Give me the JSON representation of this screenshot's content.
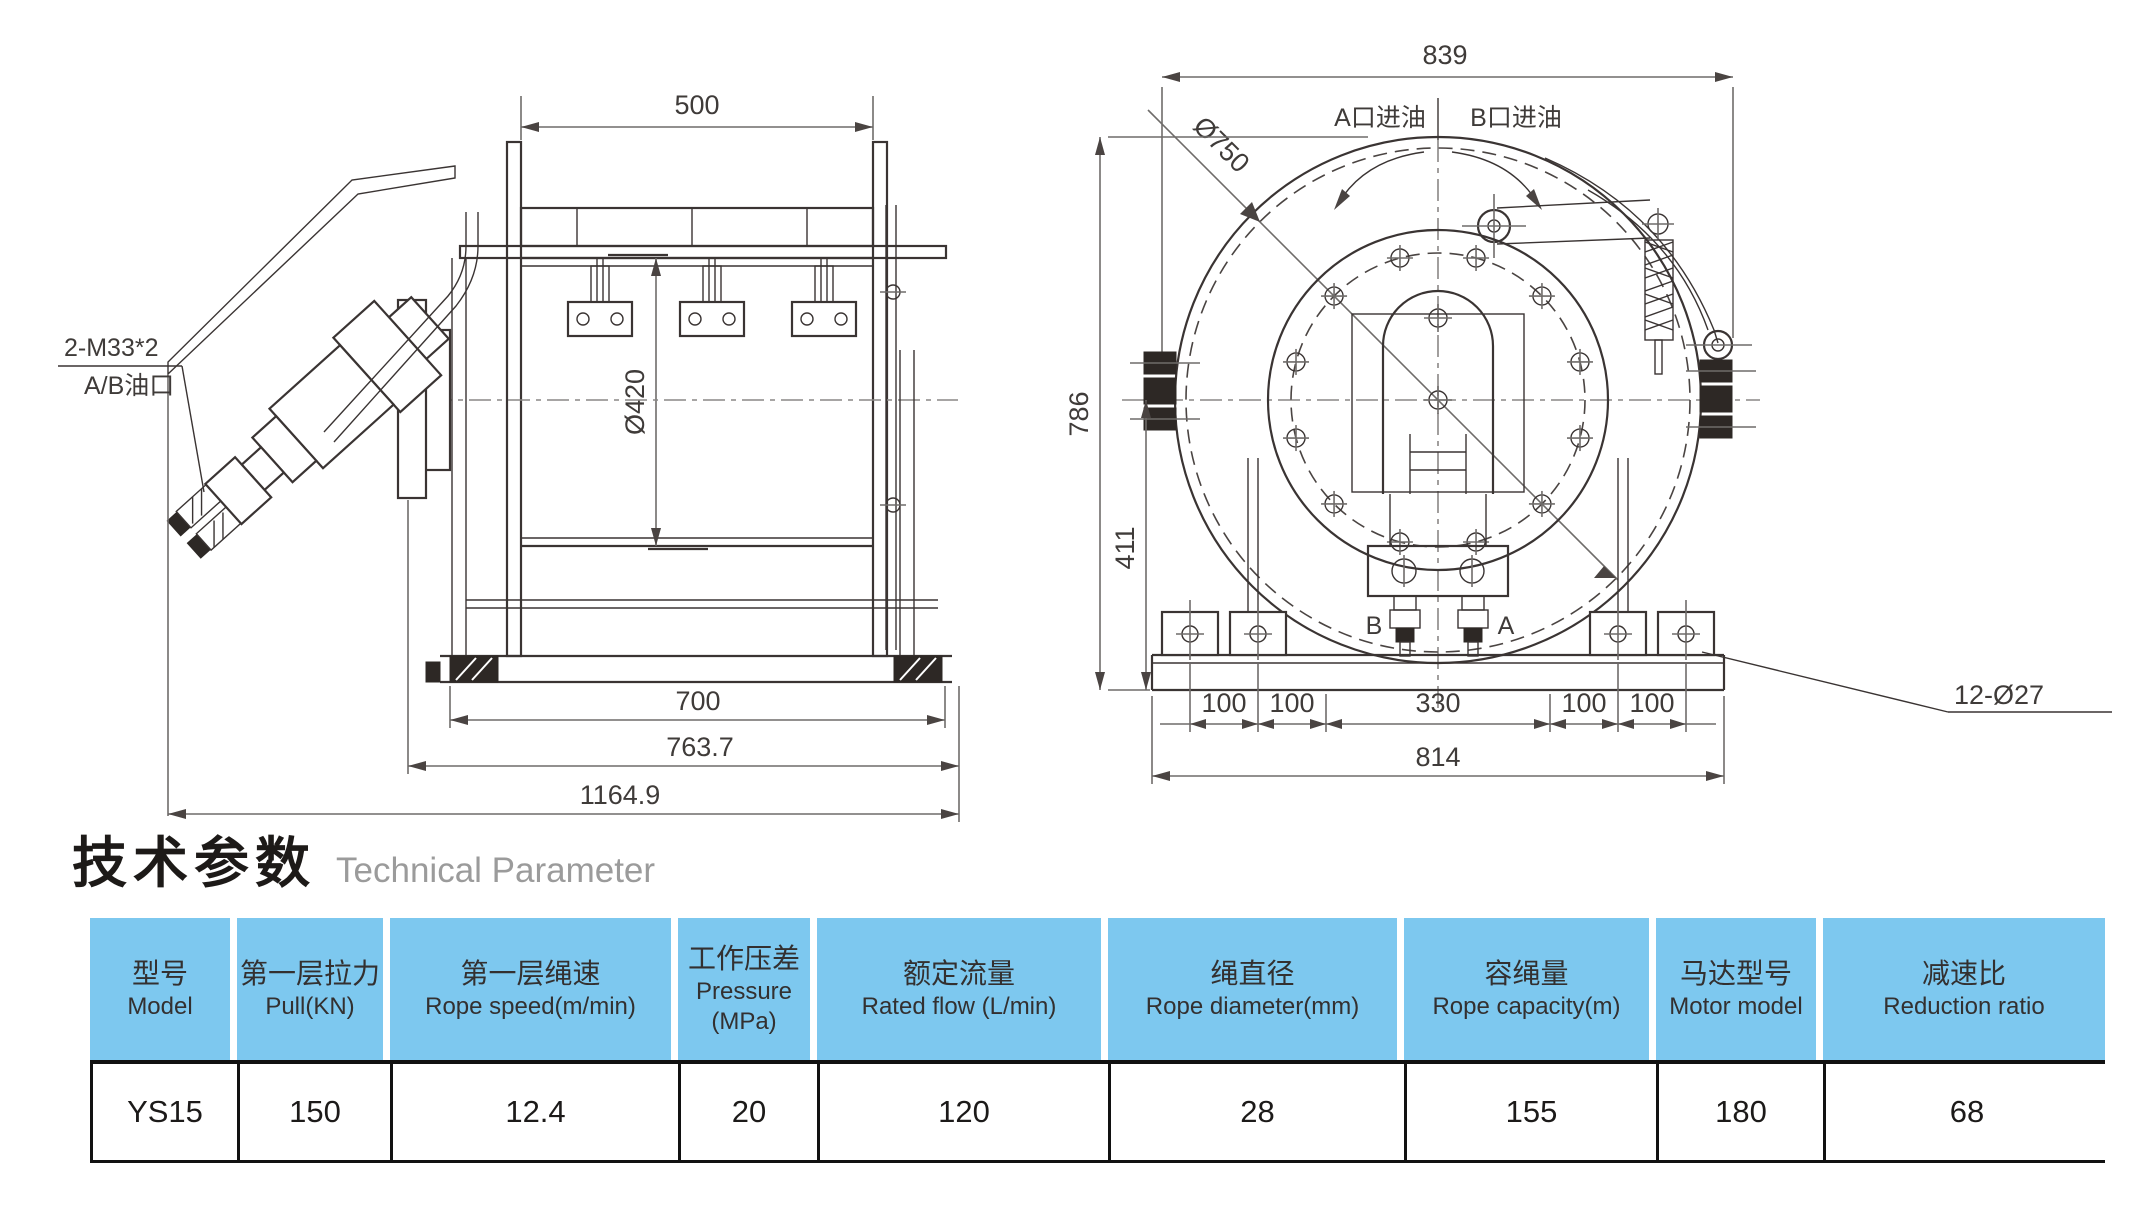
{
  "title": {
    "zh": "技术参数",
    "en": "Technical Parameter"
  },
  "colors": {
    "header_bg": "#7dc8ef",
    "line": "#3a3433",
    "dim_line": "#6f6c6a",
    "title_gray": "#9b9b9b",
    "table_border": "#111111"
  },
  "drawings": {
    "side_view": {
      "dim_width_top": "500",
      "dim_drum_dia": "Ø420",
      "dim_base_inner": "700",
      "dim_base_mid": "763.7",
      "dim_overall": "1164.9",
      "label_thread": "2-M33*2",
      "label_ports": "A/B油口"
    },
    "front_view": {
      "dim_width_top": "839",
      "dim_flange_dia": "Ø750",
      "dim_height": "786",
      "dim_center_height": "411",
      "label_port_a_inlet": "A口进油",
      "label_port_b_inlet": "B口进油",
      "label_port_b": "B",
      "label_port_a": "A",
      "bottom_dims": [
        "100",
        "100",
        "330",
        "100",
        "100"
      ],
      "dim_base_width": "814",
      "label_holes": "12-Ø27"
    }
  },
  "table": {
    "headers": [
      {
        "zh": "型号",
        "en": "Model"
      },
      {
        "zh": "第一层拉力",
        "en": "Pull(KN)"
      },
      {
        "zh": "第一层绳速",
        "en": "Rope speed(m/min)"
      },
      {
        "zh": "工作压差",
        "en": "Pressure",
        "en2": "(MPa)"
      },
      {
        "zh": "额定流量",
        "en": "Rated flow (L/min)"
      },
      {
        "zh": "绳直径",
        "en": "Rope diameter(mm)"
      },
      {
        "zh": "容绳量",
        "en": "Rope capacity(m)"
      },
      {
        "zh": "马达型号",
        "en": "Motor model"
      },
      {
        "zh": "减速比",
        "en": "Reduction ratio"
      }
    ],
    "row": [
      "YS15",
      "150",
      "12.4",
      "20",
      "120",
      "28",
      "155",
      "180",
      "68"
    ]
  }
}
